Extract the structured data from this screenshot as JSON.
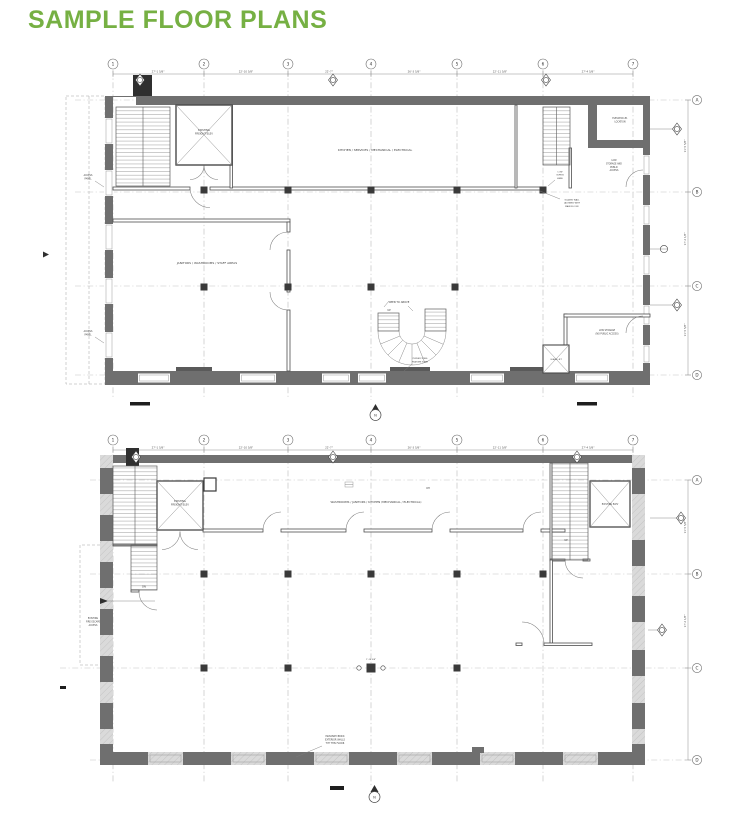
{
  "page": {
    "title": "SAMPLE FLOOR PLANS"
  },
  "colors": {
    "accent": "#76b043",
    "wall": "#6f6f6f",
    "hatch": "#dadada",
    "line": "#4e4e4e"
  },
  "plan_upper": {
    "grid_cols": [
      "1",
      "2",
      "3",
      "4",
      "5",
      "6",
      "7"
    ],
    "grid_rows": [
      "A",
      "B",
      "C",
      "D"
    ],
    "dims_top": [
      "27'-1 5/8\"",
      "22'-10 5/8\"",
      "22'-7\"",
      "26'-3 5/8\"",
      "22'-11 5/8\"",
      "27'-4 5/8\""
    ],
    "dims_right": [
      "11'-5 5/8\"",
      "17'-2 1/8\"",
      "11'-5 5/8\""
    ],
    "labels": {
      "freight_elev": [
        "EXISTING",
        "FREIGHT ELEV"
      ],
      "kitchen": "KITCHEN / SERVICES / MECHANICAL / ELECTRICAL",
      "janitors": "JANITORS / WASHROOMS / STAFF AREAS",
      "access_panel": [
        "ACCESS",
        "PANEL"
      ],
      "open_to_above": "OPEN TO ABOVE",
      "up": "UP",
      "elevator_location": [
        "ELEVATOR #1",
        "LOCATION"
      ],
      "low_storage_public": [
        "LOW",
        "STORAGE AND",
        "PUBLIC",
        "ACCESS"
      ],
      "low_cupboard": [
        "LOW",
        "CUPB'D",
        "HERE"
      ],
      "glazed_wall": [
        "GLAZED WALL",
        "(ALIGNED WITH",
        "MAIN FLOOR)"
      ],
      "low_storage_no_public": [
        "LOW STORAGE",
        "(NO PUBLIC ACCESS)"
      ],
      "glass_lift": "GLASS LIFT",
      "stair_note": [
        "CURVED STEEL",
        "FEATURE STAIR"
      ],
      "north": "N"
    }
  },
  "plan_lower": {
    "grid_cols": [
      "1",
      "2",
      "3",
      "4",
      "5",
      "6",
      "7"
    ],
    "grid_rows": [
      "A",
      "B",
      "C",
      "D"
    ],
    "dims_top": [
      "27'-1 5/8\"",
      "22'-10 5/8\"",
      "22'-7\"",
      "26'-3 5/8\"",
      "22'-11 5/8\"",
      "27'-4 5/8\""
    ],
    "dims_right": [
      "11'-5 5/8\"",
      "17'-2 1/8\""
    ],
    "labels": {
      "freight_elev": [
        "EXISTING",
        "FREIGHT ELEV"
      ],
      "washrooms": "WASHROOMS / JANITORS / KITCHEN (MECHANICAL / ELECTRICAL)",
      "existing_elev": "EXISTING ELEV",
      "fire_escape": [
        "EXISTING",
        "FIRE ESCAPE",
        "ACCESS"
      ],
      "masonry": [
        "MASONRY BRICK",
        "EXTERIOR WALLS",
        "TYP THIS FLOOR"
      ],
      "oh": "OH",
      "up": "UP",
      "dn": "DN",
      "center_col_dim": "1'-10 5/8\"",
      "north": "N"
    }
  }
}
